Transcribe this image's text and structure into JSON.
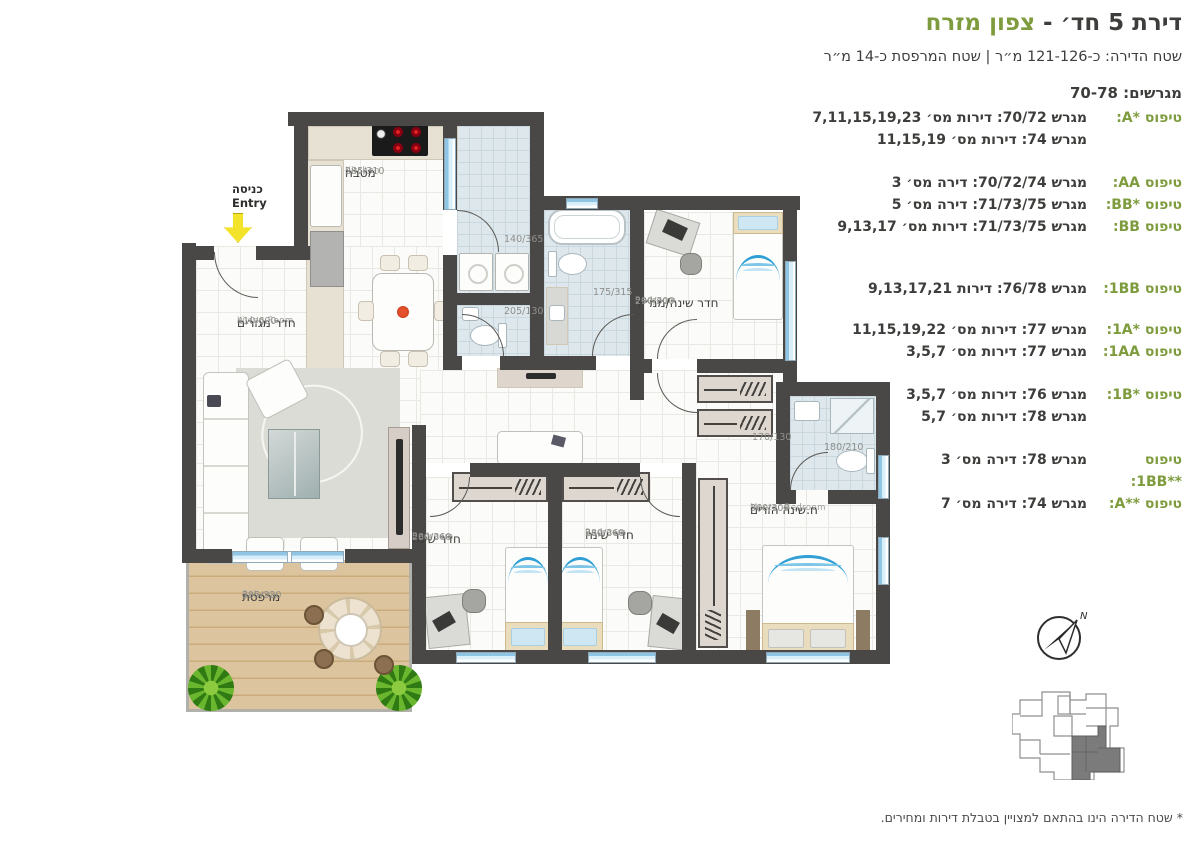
{
  "header": {
    "title_prefix": "דירת 5 חד׳ -",
    "title_highlight": "צפון מזרח",
    "subtitle": "שטח הדירה: כ-121-126 מ״ר | שטח המרפסת כ-14 מ״ר",
    "lots": "מגרשים: 70-78"
  },
  "types": [
    {
      "label": "טיפוס *A:",
      "lines": [
        "מגרש 70/72: דירות מס׳ 7,11,15,19,23",
        "מגרש 74: דירות מס׳ 11,15,19"
      ]
    },
    {
      "label": "טיפוס AA:",
      "lines": [
        "מגרש 70/72/74: דירה מס׳ 3"
      ]
    },
    {
      "label": "טיפוס *BB:",
      "lines": [
        "מגרש 71/73/75: דירה מס׳ 5"
      ]
    },
    {
      "label": "טיפוס BB:",
      "lines": [
        "מגרש 71/73/75: דירות מס׳ 9,13,17"
      ]
    },
    {
      "label": "טיפוס 1BB:",
      "lines": [
        "מגרש 76/78: דירות 9,13,17,21"
      ]
    },
    {
      "label": "טיפוס *1A:",
      "lines": [
        "מגרש 77: דירות מס׳ 11,15,19,22"
      ]
    },
    {
      "label": "טיפוס 1AA:",
      "lines": [
        "מגרש 77: דירות מס׳ 3,5,7"
      ]
    },
    {
      "label": "טיפוס *1B:",
      "lines": [
        "מגרש 76: דירות מס׳ 3,5,7",
        "מגרש 78: דירות מס׳ 5,7"
      ]
    },
    {
      "label": "טיפוס **1BB:",
      "lines": [
        "מגרש 78: דירה מס׳ 3"
      ]
    },
    {
      "label": "טיפוס **A:",
      "lines": [
        "מגרש 74: דירה מס׳ 7"
      ]
    }
  ],
  "rooms": {
    "kitchen": {
      "en": "Kitchen",
      "he": "מטבח",
      "dims": "285/310"
    },
    "living": {
      "en": "Living Room",
      "he": "חדר מגורים",
      "dims": "410/600"
    },
    "balcony": {
      "en": "Balcony",
      "he": "מרפסת",
      "dims": "395/330"
    },
    "mamad": {
      "en": "Bedroom",
      "he": "חדר שינה/ממ״ד",
      "dims": "290/300"
    },
    "bedroom1": {
      "en": "Bedroom",
      "he": "חדר שינה",
      "dims": "280/360"
    },
    "bedroom2": {
      "en": "Bedroom",
      "he": "חדר שינה",
      "dims": "280/360"
    },
    "master": {
      "en": "Master Bedroom",
      "he": "ח.שינה הורים",
      "dims": "360/300"
    },
    "utility": {
      "dims": "140/365"
    },
    "wc": {
      "dims": "205/130"
    },
    "bath": {
      "dims": "175/315"
    },
    "corridor": {
      "dims": "170/130"
    },
    "master_bath": {
      "dims": "180/210"
    }
  },
  "entry": {
    "he": "כניסה",
    "en": "Entry"
  },
  "compass": {
    "north": "N"
  },
  "footnote": "* שטח הדירה הינו בהתאם למצויין בטבלת דירות ומחירים.",
  "colors": {
    "accent_green": "#7e9c3e",
    "wall": "#4a4846",
    "text_dark": "#3d3d3b"
  }
}
